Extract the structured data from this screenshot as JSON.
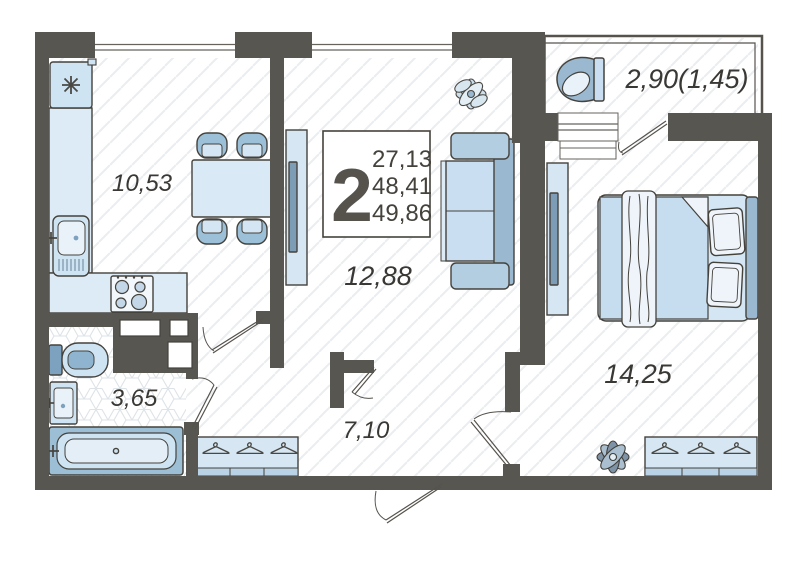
{
  "plan": {
    "legend": {
      "rooms_count": "2",
      "areas": [
        "27,13",
        "48,41",
        "49,86"
      ]
    },
    "rooms": [
      {
        "name": "kitchen",
        "area": "10,53"
      },
      {
        "name": "living-room",
        "area": "12,88"
      },
      {
        "name": "bedroom",
        "area": "14,25"
      },
      {
        "name": "bathroom",
        "area": "3,65"
      },
      {
        "name": "hallway",
        "area": "7,10"
      },
      {
        "name": "balcony",
        "area": "2,90(1,45)"
      }
    ],
    "colors": {
      "wall": "#575650",
      "outline": "#45423c",
      "furniture_light": "#d9e9f5",
      "furniture_mid": "#c2daec",
      "furniture_dark": "#8fb4cf",
      "text": "#3a3834"
    }
  }
}
